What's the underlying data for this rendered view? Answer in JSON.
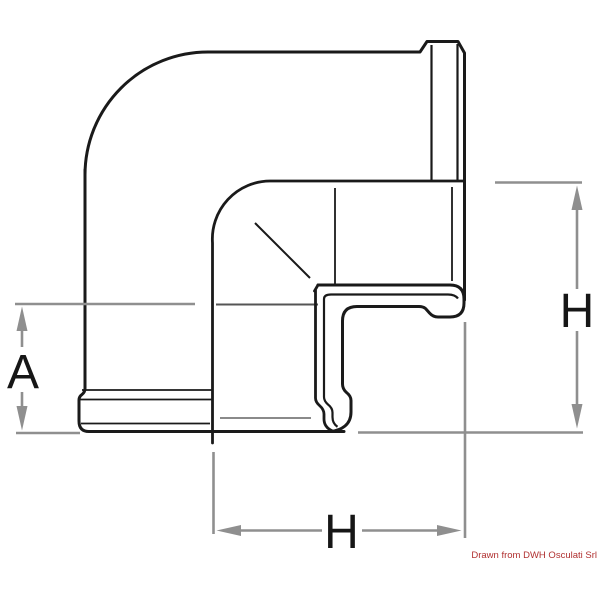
{
  "diagram": {
    "description": "Technical line drawing of a 90-degree elbow pipe fitting with dimension annotations",
    "labels": {
      "dim_a": "A",
      "dim_h_right": "H",
      "dim_h_bottom": "H"
    },
    "credit": "Drawn from DWH Osculati Srl",
    "colors": {
      "line": "#1a1a1a",
      "dimension": "#8f8f8f",
      "credit": "#b03030",
      "background": "#ffffff"
    }
  }
}
